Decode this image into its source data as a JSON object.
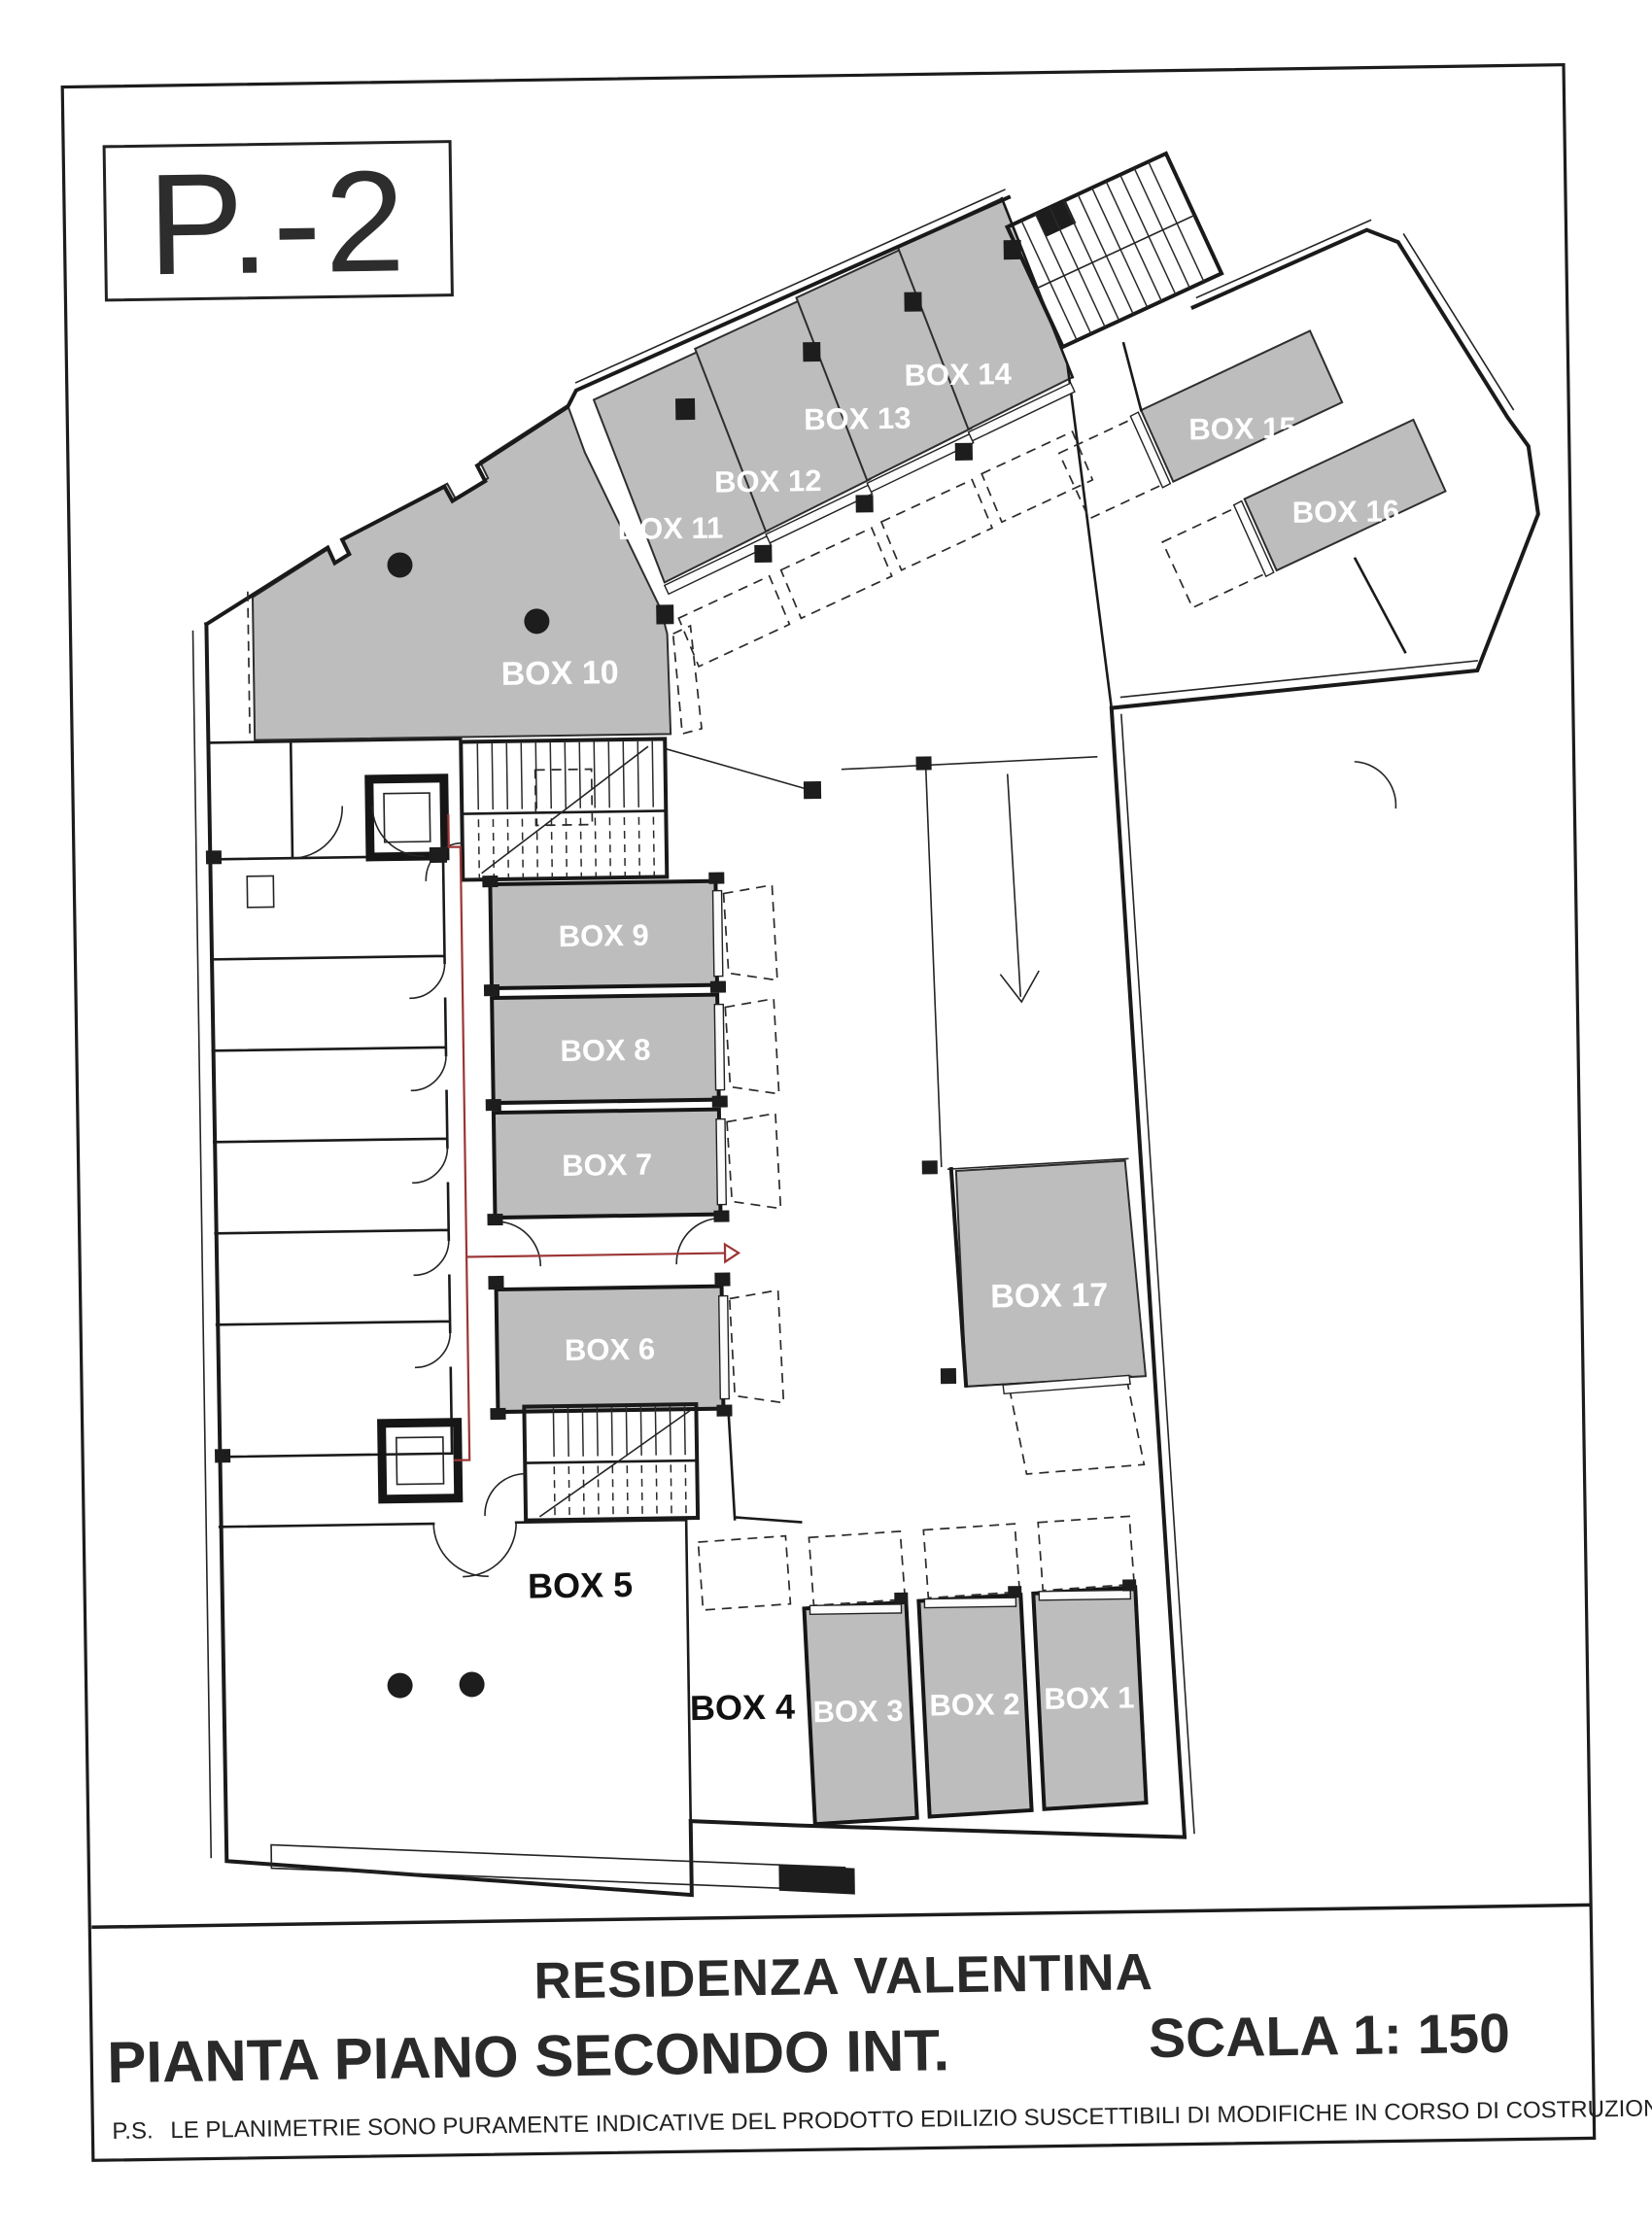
{
  "sheet": {
    "level_label": "P.-2",
    "project_title": "RESIDENZA VALENTINA",
    "drawing_title": "PIANTA PIANO SECONDO INT.",
    "scale_label": "SCALA 1: 150",
    "note_prefix": "P.S.",
    "note_text": "LE PLANIMETRIE SONO PURAMENTE INDICATIVE DEL PRODOTTO EDILIZIO SUSCETTIBILI DI MODIFICHE IN CORSO DI COSTRUZIONE"
  },
  "colors": {
    "paper": "#ffffff",
    "garage_fill": "#bdbdbd",
    "wall": "#1a1a1a",
    "escape_route": "#9c3535"
  },
  "boxes": [
    {
      "id": "box-1",
      "label": "BOX 1",
      "shaded": true
    },
    {
      "id": "box-2",
      "label": "BOX 2",
      "shaded": true
    },
    {
      "id": "box-3",
      "label": "BOX 3",
      "shaded": true
    },
    {
      "id": "box-4",
      "label": "BOX 4",
      "shaded": false
    },
    {
      "id": "box-5",
      "label": "BOX 5",
      "shaded": false
    },
    {
      "id": "box-6",
      "label": "BOX 6",
      "shaded": true
    },
    {
      "id": "box-7",
      "label": "BOX 7",
      "shaded": true
    },
    {
      "id": "box-8",
      "label": "BOX 8",
      "shaded": true
    },
    {
      "id": "box-9",
      "label": "BOX 9",
      "shaded": true
    },
    {
      "id": "box-10",
      "label": "BOX 10",
      "shaded": true
    },
    {
      "id": "box-11",
      "label": "BOX 11",
      "shaded": true
    },
    {
      "id": "box-12",
      "label": "BOX 12",
      "shaded": true
    },
    {
      "id": "box-13",
      "label": "BOX 13",
      "shaded": true
    },
    {
      "id": "box-14",
      "label": "BOX 14",
      "shaded": true
    },
    {
      "id": "box-15",
      "label": "BOX 15",
      "shaded": true
    },
    {
      "id": "box-16",
      "label": "BOX 16",
      "shaded": true
    },
    {
      "id": "box-17",
      "label": "BOX 17",
      "shaded": true
    }
  ]
}
